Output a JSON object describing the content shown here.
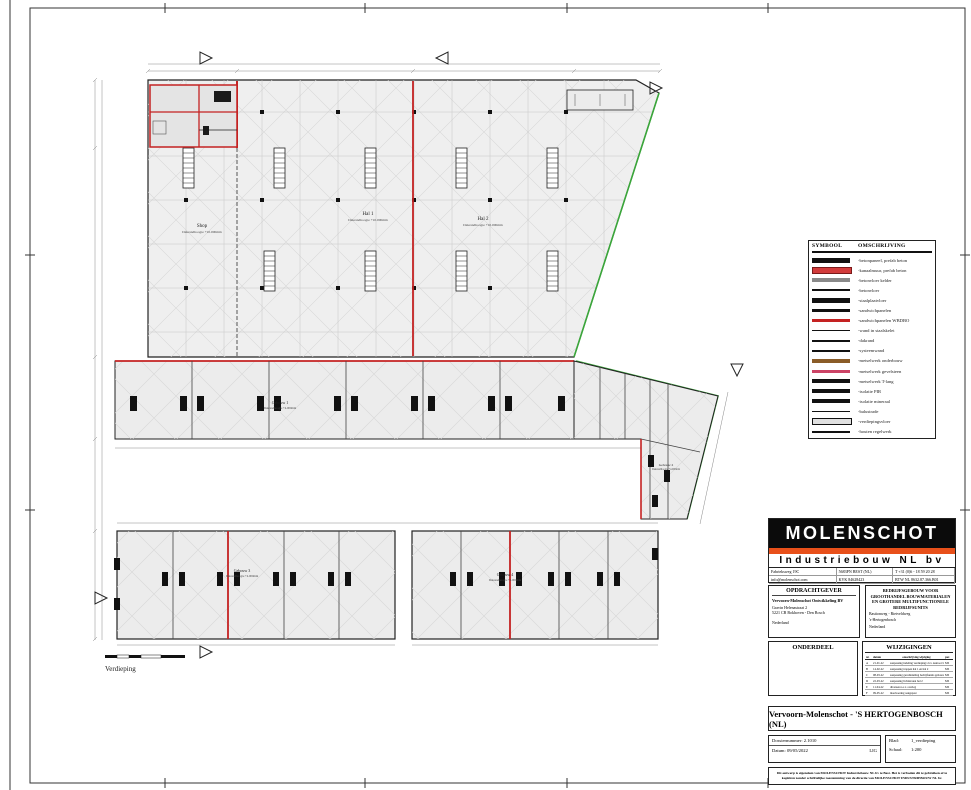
{
  "colors": {
    "accent_orange": "#e8501a",
    "wall_red": "#c42222",
    "boundary_green": "#3aa63a"
  },
  "sheet": {
    "drawing_name": "Verdieping",
    "plan_labels": {
      "shop": "Shop",
      "shop_height": "Dakrandhoogte +10.000mm",
      "hal1": "Hal 1",
      "hal1_height": "Dakrandhoogte +10.000mm",
      "hal2": "Hal 2",
      "hal2_height": "Dakrandhoogte +10.000mm",
      "gebouw1": "Gebouw 1",
      "gebouw1_height": "Dakrandhoogte +4.000mm",
      "gebouw2": "Gebouw 2",
      "gebouw2_height": "Dakrandhoogte +4.000mm",
      "gebouw3": "Gebouw 3",
      "gebouw3_height": "Dakrandhoogte +4.000mm",
      "gebouw4": "Gebouw 4",
      "gebouw4_height": "Dakrandhoogte +4.000mm"
    }
  },
  "legend": {
    "title_symbol": "SYMBOOL",
    "title_desc": "OMSCHRIJVING",
    "rows": [
      {
        "label": "-betonpaneel, prefab beton",
        "color": "#111111",
        "h": "5px",
        "border": ""
      },
      {
        "label": "-kanaalmuur, prefab beton",
        "color": "#d23b3b",
        "h": "5px",
        "border": "1px solid #7a1a1a"
      },
      {
        "label": "-betonvloer kelder",
        "color": "#8a8a8a",
        "h": "4px",
        "border": ""
      },
      {
        "label": "-betonvloer",
        "color": "#111111",
        "h": "2px",
        "border": ""
      },
      {
        "label": "-staalplaatvloer",
        "color": "#111111",
        "h": "5px",
        "border": ""
      },
      {
        "label": "-sandwichpanelen",
        "color": "#111111",
        "h": "3.5px",
        "border": ""
      },
      {
        "label": "-sandwichpanelen WBDBO",
        "color": "#c42222",
        "h": "3.5px",
        "border": ""
      },
      {
        "label": "-wand in staalskelet",
        "color": "#111111",
        "h": "1.5px",
        "border": ""
      },
      {
        "label": "-dakrand",
        "color": "#111111",
        "h": "1.5px",
        "border": ""
      },
      {
        "label": "-systeemwand",
        "color": "#111111",
        "h": "1.5px",
        "border": ""
      },
      {
        "label": "-metselwerk onderbouw",
        "color": "#8a5c28",
        "h": "4.5px",
        "border": ""
      },
      {
        "label": "-metselwerk gevelsteen",
        "color": "#cc4466",
        "h": "3px",
        "border": ""
      },
      {
        "label": "-metselwerk T-lang",
        "color": "#111111",
        "h": "4.5px",
        "border": ""
      },
      {
        "label": "-isolatie PIR",
        "color": "#111111",
        "h": "4px",
        "border": ""
      },
      {
        "label": "-isolatie mineraal",
        "color": "#111111",
        "h": "4px",
        "border": ""
      },
      {
        "label": "-balustrade",
        "color": "#111111",
        "h": "1px",
        "border": ""
      },
      {
        "label": "-verdiepingsvloer",
        "color": "#e0e0e0",
        "h": "5px",
        "border": "1px solid #111"
      },
      {
        "label": "-houten regelwerk",
        "color": "#111111",
        "h": "2px",
        "border": ""
      }
    ]
  },
  "titleblock": {
    "brand": "MOLENSCHOT",
    "brand_sub": "Industriebouw NL bv",
    "contact_rows": [
      {
        "c1": "Fabrieksweg 19C",
        "c2": "5683PN BEST (NL)",
        "c3": "T +31 (0)6 - 18 59 20 28"
      },
      {
        "c1": "info@molenschot.com",
        "c2": "KVK 84628423",
        "c3": "BTW NL 8632.87.366.B01"
      }
    ],
    "opdrachtgever": {
      "title": "OPDRACHTGEVER",
      "name": "Vervoorn-Molenschot Ontwikkeling BV",
      "addr1": "Gravin Helenastraat 2",
      "addr2": "5221 CB Bokhoven - Den Bosch",
      "country": "Nederland"
    },
    "project_desc": {
      "title": "BEDRIJFSGEBOUW VOOR GROOTHANDEL BOUWMATERIALEN EN GROTERE MULTIFUNCTIONELE BEDRIJFSUNITS",
      "line1": "Bastionweg - Rietveldweg",
      "line2": "'s-Hertogenbosch",
      "country": "Nederland"
    },
    "onderdeel": {
      "title": "ONDERDEEL",
      "items": [
        {
          "t": "1. situatieplan"
        },
        {
          "t": "2. begane grond"
        },
        {
          "t": "3. verdieping"
        },
        {
          "t": "4. gevels_doorsnedes"
        },
        {
          "t": "5. details"
        },
        {
          "t": "6. parkeerplan"
        },
        {
          "t": "7. funderings_tekening"
        },
        {
          "t": "8. beplantingstekening"
        }
      ]
    },
    "wijzigingen": {
      "title": "WIJZIGINGEN",
      "col_nr": "nr.",
      "col_datum": "datum",
      "col_oms": "omschrijving wijziging",
      "col_par": "par.",
      "rows": [
        {
          "nr": "A",
          "datum": "21-01-22",
          "oms": "aanpassing indeling verdieping t.b.v. kantoor blad 1",
          "par": "MS"
        },
        {
          "nr": "B",
          "datum": "14-02-22",
          "oms": "aanpassing trappen hal 1 en hal 2",
          "par": "MS"
        },
        {
          "nr": "C",
          "datum": "08-03-22",
          "oms": "aanpassing gevelindeling bedrijfsunits gebouw 3 en 4",
          "par": "MS"
        },
        {
          "nr": "D",
          "datum": "22-03-22",
          "oms": "aanpassing lichtstraten hal 2",
          "par": "MS"
        },
        {
          "nr": "E",
          "datum": "11-04-22",
          "oms": "diversen n.a.v. overleg",
          "par": "MS"
        },
        {
          "nr": "F",
          "datum": "09-05-22",
          "oms": "maatvoering aangepast",
          "par": "MS"
        }
      ]
    },
    "project_title": "Vervoorn-Molenschot - 'S HERTOGENBOSCH (NL)",
    "dossier_label": "Dossiernummer:",
    "dossier": "2.1010",
    "datum_label": "Datum:",
    "datum": "09/05/2022",
    "code": "LIG",
    "blad_label": "Blad:",
    "blad": "1_verdieping",
    "schaal_label": "Schaal:",
    "schaal": "1:200",
    "disclaimer": "Dit ontwerp is eigendom van MOLENSCHOT Industriebouw NL bv te Best. Het is verboden dit te gebruiken of te kopiëren zonder schriftelijke toestemming van de directie van MOLENSCHOT INDUSTRIEBOUW NL bv."
  }
}
